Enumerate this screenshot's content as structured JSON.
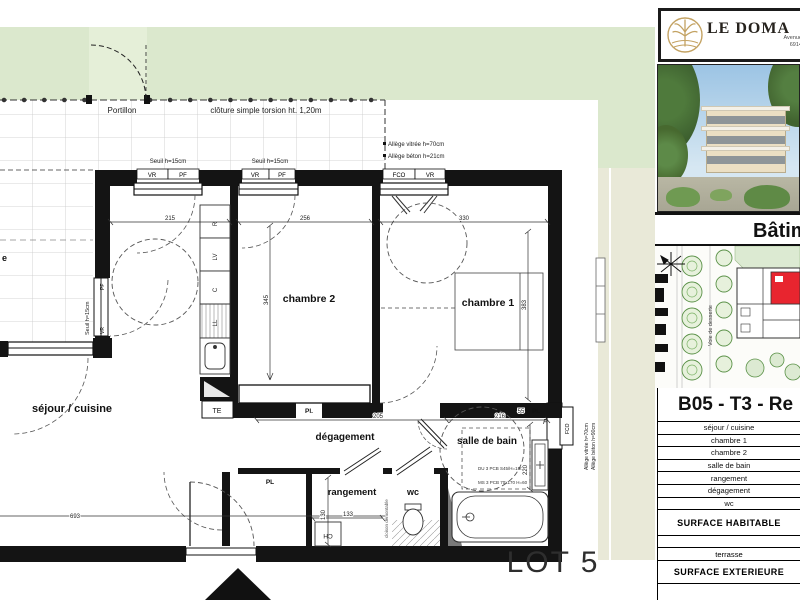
{
  "plan": {
    "site": {
      "portillon": "Portillon",
      "cloture": "clôture simple torsion ht. 1,20m",
      "seuil": "Seuil h=15cm",
      "allege_vitree": "Allège vitrée h=70cm",
      "allege_beton": "Allège béton h=21cm",
      "allege_r1": "Allège vitrée h=70cm",
      "allege_r2": "Allège béton h=90cm",
      "terrasse_fragment": "e"
    },
    "rooms": {
      "sejour": "séjour / cuisine",
      "chambre1": "chambre 1",
      "chambre2": "chambre 2",
      "degagement": "dégagement",
      "salle_de_bain": "salle de bain",
      "rangement": "rangement",
      "wc": "wc"
    },
    "fixtures": {
      "te": "TE",
      "pl": "Pl.",
      "pl2": "PL",
      "ch": "CH",
      "f": "F",
      "r": "R",
      "lv": "LV",
      "c": "C",
      "ll": "LL",
      "cloison": "cloison démontable",
      "note1": "DU 3 PCB S45/H=150",
      "note2": "MS 3 PCB 70x170 H=60"
    },
    "windows": {
      "vr": "VR",
      "pf": "PF",
      "fco": "FCO"
    },
    "dims": {
      "d215": "215",
      "d256": "256",
      "d330": "330",
      "d345": "345",
      "d383": "383",
      "d205": "205",
      "d216": "216",
      "d55": "55",
      "d220": "220",
      "d130": "130",
      "d133": "133",
      "d693": "693"
    },
    "lot": "LOT 5"
  },
  "sidebar": {
    "logo": {
      "name": "LE DOMA",
      "address_line1": "Avenue",
      "address_line2": "6914"
    },
    "batiment": "Bâtim",
    "siteplan": {
      "voie": "Voie de desserte"
    },
    "unit_title": "B05 - T3 - Re",
    "table": {
      "rows": [
        "séjour / cuisine",
        "chambre 1",
        "chambre 2",
        "salle de bain",
        "rangement",
        "dégagement",
        "wc"
      ],
      "surface_habitable": "SURFACE HABITABLE",
      "terrasse": "terrasse",
      "surface_exterieure": "SURFACE EXTERIEURE"
    }
  }
}
